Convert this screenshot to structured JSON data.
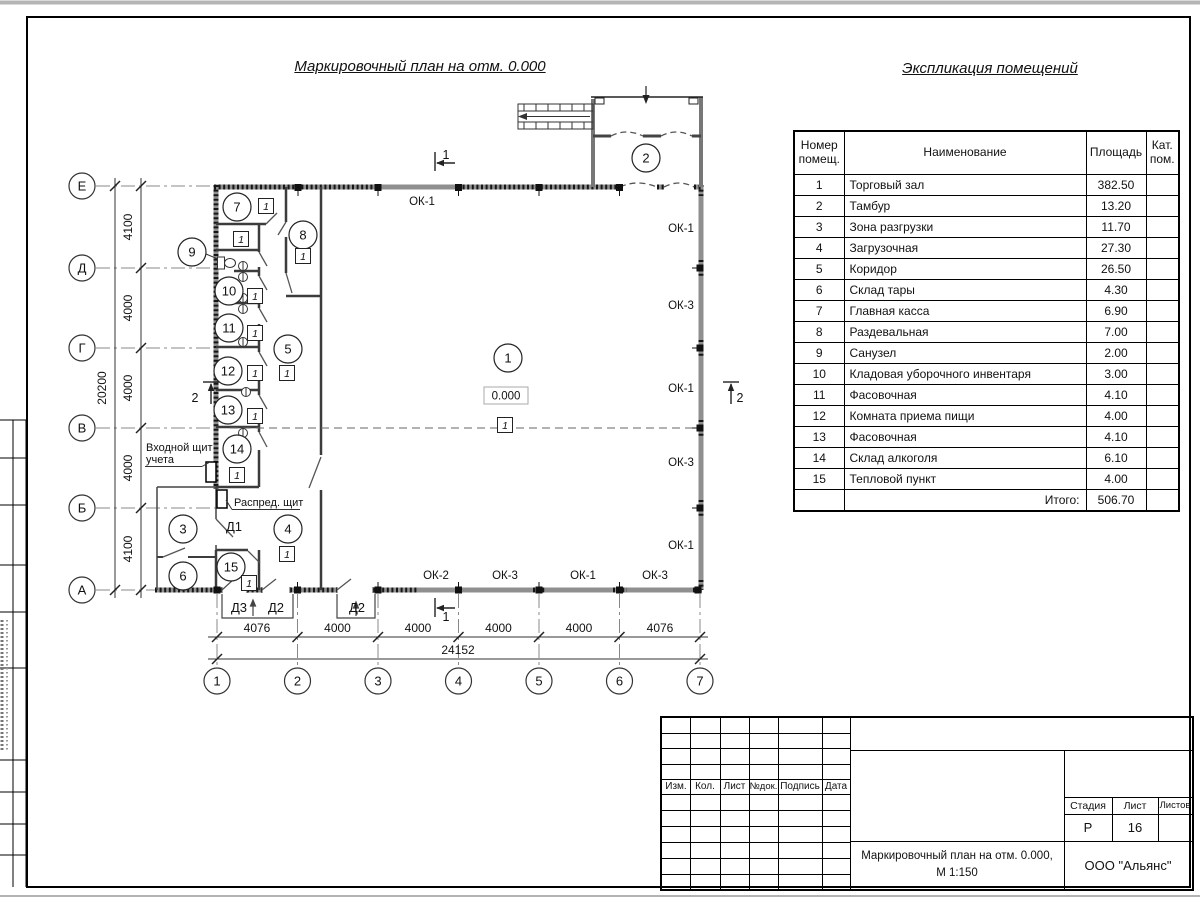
{
  "sheet": {
    "plan_title": "Маркировочный план на отм. 0.000",
    "explication_title": "Экспликация помещений"
  },
  "explication": {
    "headers": {
      "num": "Номер помещ.",
      "name": "Наименование",
      "area": "Площадь",
      "cat": "Кат. пом."
    },
    "rows": [
      {
        "num": "1",
        "name": "Торговый зал",
        "area": "382.50"
      },
      {
        "num": "2",
        "name": "Тамбур",
        "area": "13.20"
      },
      {
        "num": "3",
        "name": "Зона разгрузки",
        "area": "11.70"
      },
      {
        "num": "4",
        "name": "Загрузочная",
        "area": "27.30"
      },
      {
        "num": "5",
        "name": "Коридор",
        "area": "26.50"
      },
      {
        "num": "6",
        "name": "Склад тары",
        "area": "4.30"
      },
      {
        "num": "7",
        "name": "Главная касса",
        "area": "6.90"
      },
      {
        "num": "8",
        "name": "Раздевальная",
        "area": "7.00"
      },
      {
        "num": "9",
        "name": "Санузел",
        "area": "2.00"
      },
      {
        "num": "10",
        "name": "Кладовая уборочного инвентаря",
        "area": "3.00"
      },
      {
        "num": "11",
        "name": "Фасовочная",
        "area": "4.10"
      },
      {
        "num": "12",
        "name": "Комната приема пищи",
        "area": "4.00"
      },
      {
        "num": "13",
        "name": "Фасовочная",
        "area": "4.10"
      },
      {
        "num": "14",
        "name": "Склад алкоголя",
        "area": "6.10"
      },
      {
        "num": "15",
        "name": "Тепловой пункт",
        "area": "4.00"
      }
    ],
    "total_label": "Итого:",
    "total": "506.70"
  },
  "plan": {
    "axes_letters": [
      "Е",
      "Д",
      "Г",
      "В",
      "Б",
      "А"
    ],
    "axes_numbers": [
      "1",
      "2",
      "3",
      "4",
      "5",
      "6",
      "7"
    ],
    "dims_left": [
      "4100",
      "4000",
      "4000",
      "4000",
      "4100"
    ],
    "dims_left_total": "20200",
    "dims_bottom": [
      "4076",
      "4000",
      "4000",
      "4000",
      "4000",
      "4076"
    ],
    "dims_bottom_total": "24152",
    "elevation": "0.000",
    "floor_marker": "1",
    "window_types": {
      "ok1": "ОК-1",
      "ok2": "ОК-2",
      "ok3": "ОК-3"
    },
    "door_types": {
      "d1": "Д1",
      "d2": "Д2",
      "d3": "Д3"
    },
    "section_marks": {
      "s1": "1",
      "s2": "2"
    },
    "labels": {
      "entry_panel_line1": "Входной щит",
      "entry_panel_line2": "учета",
      "distribution_panel": "Распред. щит"
    }
  },
  "title_block": {
    "cols": [
      "Изм.",
      "Кол.",
      "Лист",
      "№док.",
      "Подпись",
      "Дата"
    ],
    "stage_label": "Стадия",
    "sheet_label": "Лист",
    "sheets_label": "Листов",
    "stage": "Р",
    "sheet_num": "16",
    "doc_title_line1": "Маркировочный план на отм. 0.000,",
    "doc_title_line2": "М 1:150",
    "company": "ООО \"Альянс\""
  }
}
